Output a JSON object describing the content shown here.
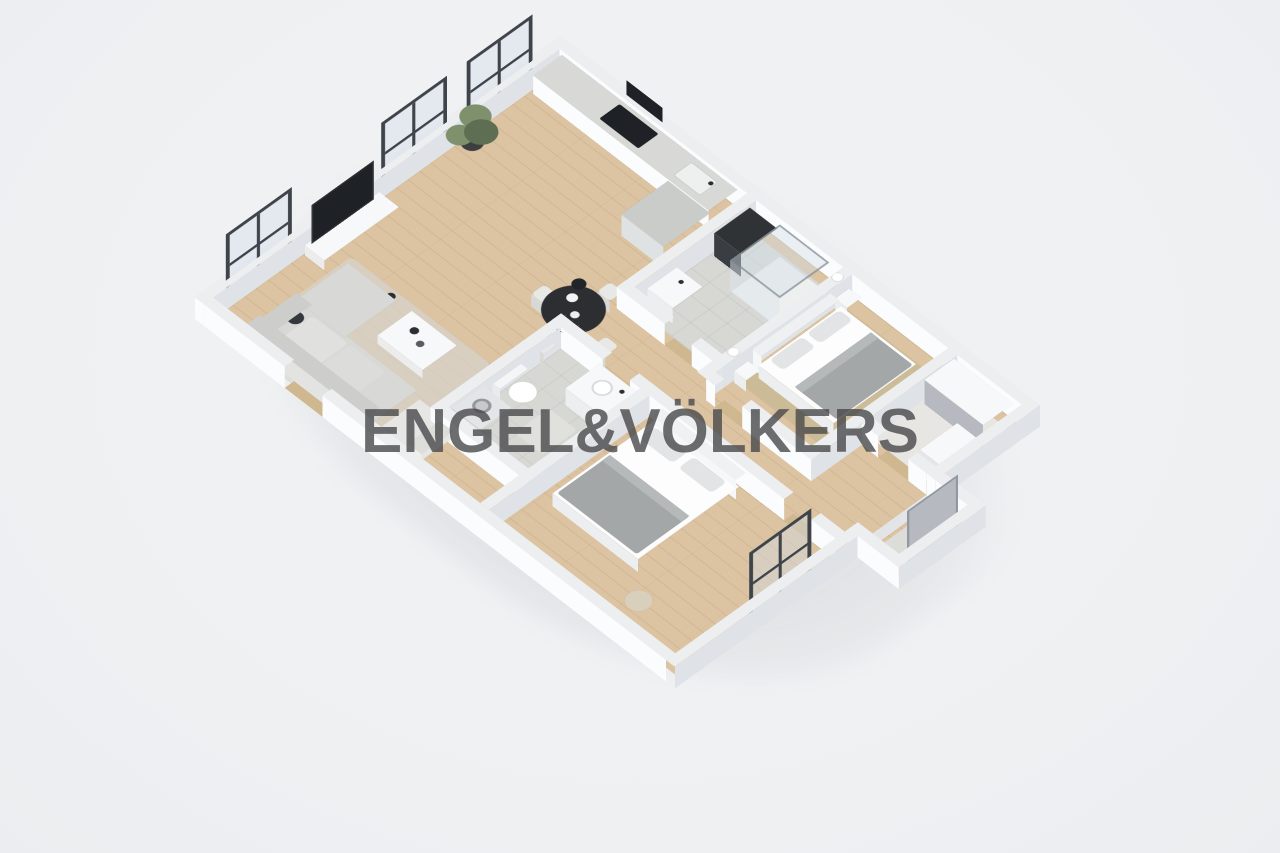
{
  "watermark": {
    "text": "ENGEL&VÖLKERS"
  },
  "scene": {
    "kind": "3d-isometric-floorplan-render",
    "description": "Dollhouse cutaway 3D floor plan of a two-bedroom apartment, white low-cut walls, oak wood flooring, viewed from above at an angle",
    "rooms": [
      "open-plan living room with kitchen",
      "shower bathroom",
      "bedroom one",
      "walk-in closet",
      "entrance hall",
      "hallway",
      "toilet bathroom",
      "bedroom two"
    ]
  },
  "objects": {
    "kitchen": [
      "kitchen counter",
      "cooktop",
      "built-in oven",
      "kitchen sink",
      "extractor hood",
      "low cabinet"
    ],
    "living": [
      "wall-mounted tv",
      "tv sideboard",
      "potted plant",
      "corner sofa",
      "coffee table",
      "armchair",
      "area rug",
      "round dining table",
      "four dining chairs",
      "pendant lamp",
      "three framed windows"
    ],
    "shower_bathroom": [
      "glass shower enclosure",
      "washing machine column",
      "washbasin"
    ],
    "bedroom_one": [
      "double bed",
      "two nightstands",
      "two wall sconces",
      "bedside bench",
      "tan rug"
    ],
    "closet": [
      "wardrobe with gray front",
      "dresser"
    ],
    "entrance": [
      "entry door",
      "doormat"
    ],
    "toilet_bathroom": [
      "toilet",
      "vanity with basin",
      "washing machine",
      "bath mat"
    ],
    "bedroom_two": [
      "double bed",
      "round pouf",
      "framed window"
    ]
  },
  "colors": {
    "bg": "#f0f1f3",
    "wall_top": "#eceef0",
    "wall_side": "#fbfcfd",
    "wall_side2": "#dfe2e6",
    "wood": "#dcc3a1",
    "wood_seam": "rgba(125,90,50,0.12)",
    "tile": "#d7d8d4",
    "closet_floor": "#e8e6e2",
    "dark": "#1e2125",
    "dark2": "#2c2e31",
    "frame": "#3f444a",
    "glass": "rgba(210,221,230,0.42)",
    "counter": "#d8d9d7",
    "cabinet": "#c9ccc9",
    "sofa": "#d8d9d6",
    "sofa_dark": "#cdcecb",
    "white_furn": "#f7f8f9",
    "blanket": "#a4a7a8",
    "pillow": "#e3e4e6",
    "rug": "rgba(213,214,210,0.65)",
    "rug_tan": "#cbbc97",
    "panel": "#b6bac0",
    "threshold": "#cfb78f",
    "pouf": "#d8cfbc",
    "plant": "#7f906d",
    "plant_dark": "#5d6e52",
    "watermark": "rgba(73,73,75,0.8)"
  }
}
